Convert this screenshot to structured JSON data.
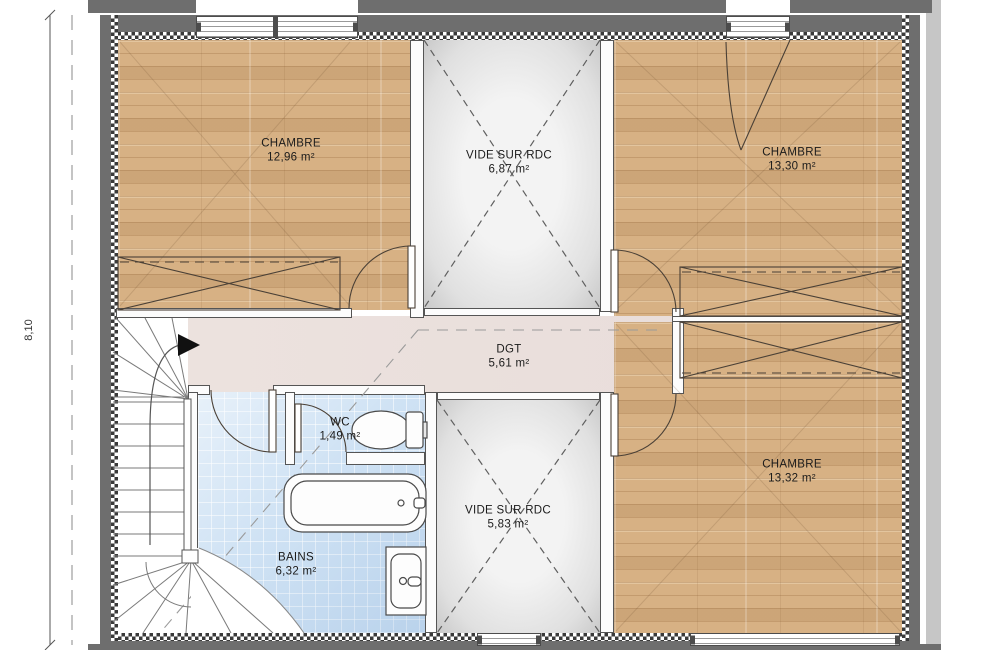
{
  "plan": {
    "dimension_label": "8,10",
    "rooms": [
      {
        "name": "CHAMBRE",
        "area": "12,96 m²"
      },
      {
        "name": "VIDE SUR RDC",
        "area": "6,87 m²"
      },
      {
        "name": "CHAMBRE",
        "area": "13,30 m²"
      },
      {
        "name": "DGT",
        "area": "5,61 m²"
      },
      {
        "name": "WC",
        "area": "1,49 m²"
      },
      {
        "name": "BAINS",
        "area": "6,32 m²"
      },
      {
        "name": "VIDE SUR RDC",
        "area": "5,83 m²"
      },
      {
        "name": "CHAMBRE",
        "area": "13,32 m²"
      }
    ],
    "colors": {
      "wall": "#6e6e6e",
      "wood_floor": "#d7b184",
      "tile_blue": "#cfe2f4",
      "void_gray": "#e9e9e9",
      "corridor_pink": "#ece2de"
    }
  }
}
